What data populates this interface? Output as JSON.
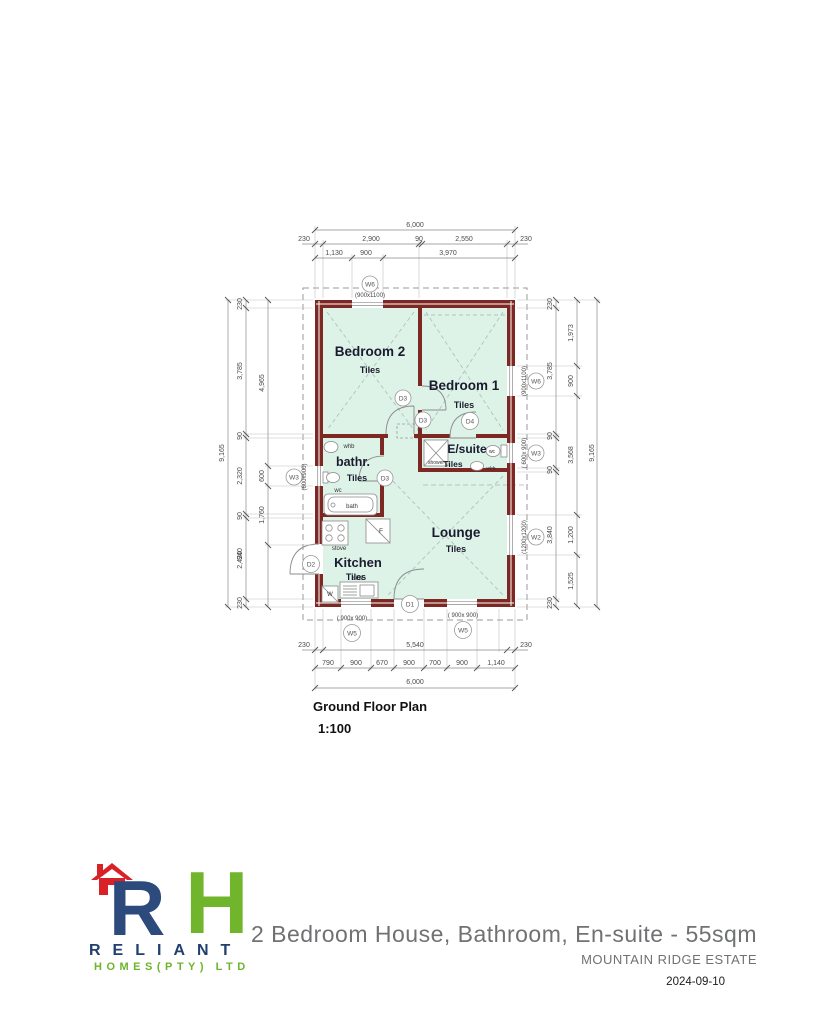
{
  "caption": {
    "title": "Ground Floor Plan",
    "scale": "1:100"
  },
  "rooms": {
    "bedroom2": {
      "name": "Bedroom 2",
      "finish": "Tiles"
    },
    "bedroom1": {
      "name": "Bedroom 1",
      "finish": "Tiles"
    },
    "ensuite": {
      "name": "E/suite",
      "finish": "Tiles"
    },
    "bathroom": {
      "name": "bathr.",
      "finish": "Tiles"
    },
    "kitchen": {
      "name": "Kitchen",
      "finish": "Tiles"
    },
    "lounge": {
      "name": "Lounge",
      "finish": "Tiles"
    }
  },
  "fixtures": {
    "whb": "whb",
    "wc": "wc",
    "bath": "bath",
    "shower": "shower",
    "stove": "stove",
    "sink": "sink",
    "fridge": "F",
    "washer": "W"
  },
  "tags": {
    "w6": "W6",
    "w5": "W5",
    "w3": "W3",
    "w2": "W2",
    "d1": "D1",
    "d2": "D2",
    "d3": "D3",
    "d4": "D4"
  },
  "sizes": {
    "w6": "(900x1100)",
    "w5": "( 900x 900)",
    "w3l": "(600x900)",
    "w3r": "( 600x 900)",
    "w2": "(1200x1200)"
  },
  "dims": {
    "d6000": "6,000",
    "d9165": "9,165",
    "d230": "230",
    "d2900": "2,900",
    "d90": "90",
    "d2550": "2,550",
    "d1130": "1,130",
    "d900": "900",
    "d3970": "3,970",
    "d5540": "5,540",
    "d790": "790",
    "d670": "670",
    "d700": "700",
    "d1140": "1,140",
    "d3785": "3,785",
    "d2320": "2,320",
    "d940": "940",
    "d2420": "2,420",
    "d4965": "4,965",
    "d600": "600",
    "d1760": "1,760",
    "d3840": "3,840",
    "d1973": "1,973",
    "d3568": "3,568",
    "d1200": "1,200",
    "d1525": "1,525"
  },
  "colors": {
    "wall": "#7d2823",
    "floor": "#ddf3e8",
    "blue": "#2c4a7c",
    "green": "#71b52c",
    "red": "#da2128"
  },
  "footer": {
    "logo_letter_r": "R",
    "logo_letter_h": "H",
    "brand": "RELIANT",
    "brand_sub": "HOMES(PTY) LTD",
    "doc_title": "2 Bedroom House, Bathroom, En-suite - 55sqm",
    "estate": "MOUNTAIN RIDGE ESTATE",
    "date": "2024-09-10"
  }
}
